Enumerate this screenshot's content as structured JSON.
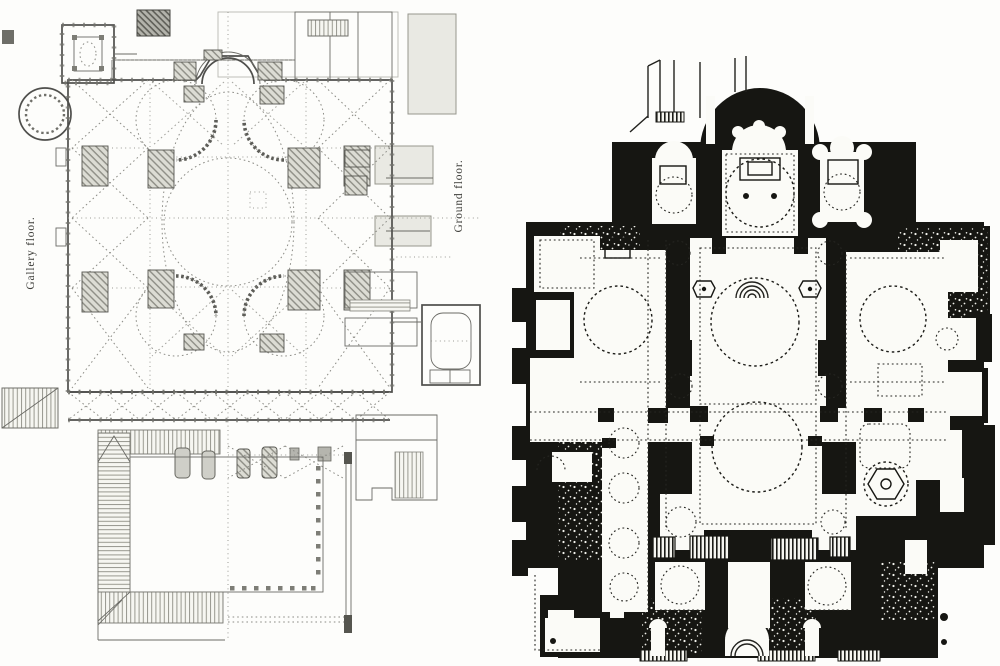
{
  "figure": {
    "plate_background": "#fdfdfb",
    "left_plan": {
      "title": "line-engraved church plan, half gallery / half ground level",
      "label_left": "Gallery floor.",
      "label_right": "Ground floor.",
      "ink": "#4f4f4c",
      "dash_ink": "#8c8c86",
      "hatch_fill": "#dcdcd4"
    },
    "right_plan": {
      "title": "solid black poché church plan",
      "ink": "#161612",
      "paper": "#fbfbf7"
    }
  }
}
